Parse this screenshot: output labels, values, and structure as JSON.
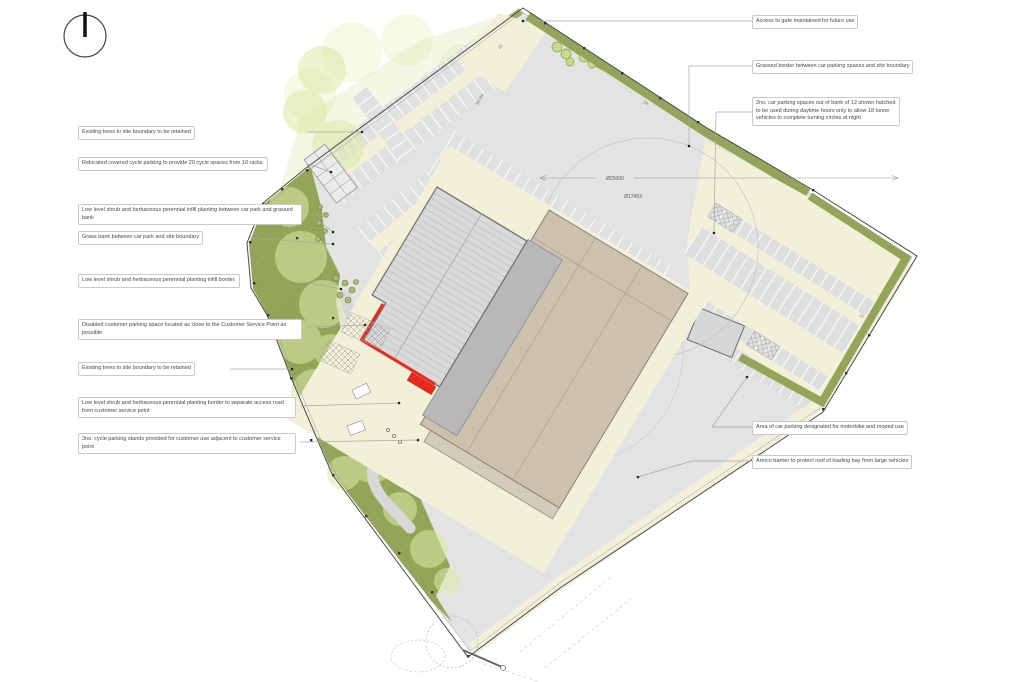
{
  "annotations": {
    "left": [
      {
        "text": "Existing trees to site boundary to be retained"
      },
      {
        "text": "Relocated covered cycle parking to provide 20 cycle spaces from 10 racks"
      },
      {
        "text": "Low level shrub and herbaceous perennial infill planting between car park and grassed bank"
      },
      {
        "text": "Grass bank between car park and site boundary"
      },
      {
        "text": "Low level shrub and herbaceous perennial planting infill border."
      },
      {
        "text": "Disabled customer parking space located as close to the Customer Service Point as possible"
      },
      {
        "text": "Existing trees to site boundary to be retained"
      },
      {
        "text": "Low level shrub and herbaceous perennial planting border to separate access road from customer service point"
      },
      {
        "text": "3no. cycle parking stands provided for customer use adjacent to customer service point"
      }
    ],
    "right": [
      {
        "text": "Access to gate maintained for future use"
      },
      {
        "text": "Grassed border between car parking spaces and site boundary"
      },
      {
        "text": "2no. car parking spaces out of bank of 12 shown hatched to be used during daytime hours only to allow 18 tonne vehicles to complete turning circles at night"
      },
      {
        "text": "Area of car parking designated for motorbike and moped use"
      },
      {
        "text": "Armco barrier to protect roof of loading bay from large vehicles"
      }
    ]
  },
  "dimensions": {
    "turning_circle_outer": "Ø25000",
    "turning_circle_inner": "Ø17453",
    "row_length": "30.3m",
    "count_row_a": "10",
    "count_row_b": "20",
    "count_row_c": "12"
  },
  "icons": {
    "north": "north-arrow"
  },
  "colors": {
    "grass": "#93a556",
    "grass_light": "#a6b765",
    "canopy": "#dfeaa8",
    "cream": "#f3f0da",
    "asphalt": "#e3e3e3",
    "roof": "#d9d9d9",
    "roof_dark": "#b8b8b8",
    "tan": "#ccc1ad",
    "tan_light": "#d5cbb9",
    "red": "#e8291d",
    "boundary": "#4a4a4a"
  }
}
